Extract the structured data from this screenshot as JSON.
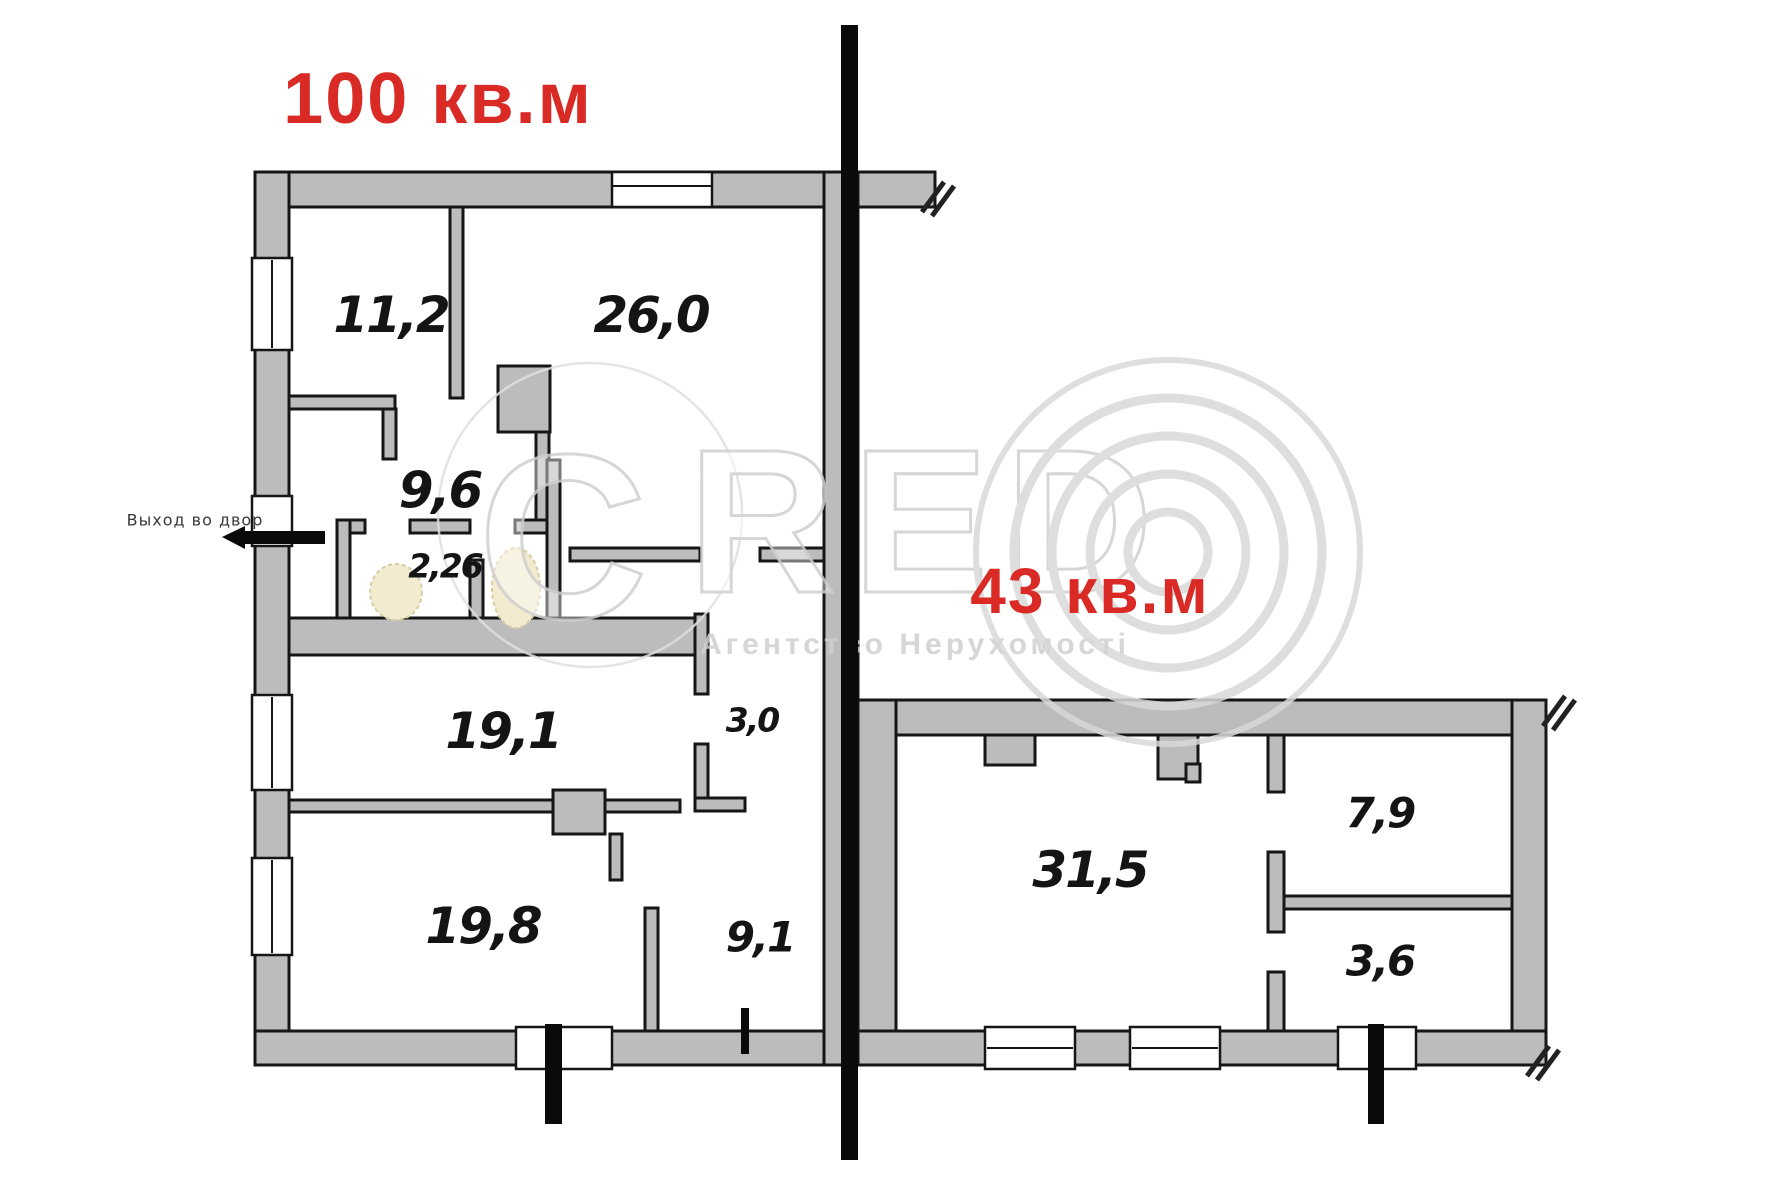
{
  "document_type": "apartment floor plan",
  "sections": {
    "left": {
      "area_label": "100 кв.м",
      "room_areas": [
        "11,2",
        "26,0",
        "9,6",
        "2,26",
        "19,1",
        "3,0",
        "19,8",
        "9,1"
      ],
      "exit_label": "Выход во двор"
    },
    "right": {
      "area_label": "43 кв.м",
      "room_areas": [
        "31,5",
        "7,9",
        "3,6"
      ]
    }
  },
  "watermark": {
    "letter_c": "C",
    "letters_red": "RED",
    "subtitle": "Агентство Нерухомості"
  },
  "colors": {
    "background": "#ffffff",
    "wall_fill": "#bcbcbc",
    "wall_stroke": "#161616",
    "split_line_black": "#0a0a0a",
    "accent_red": "#d92a25",
    "watermark_gray": "#d7d7d7",
    "fixture_beige": "#f2ebcf"
  }
}
